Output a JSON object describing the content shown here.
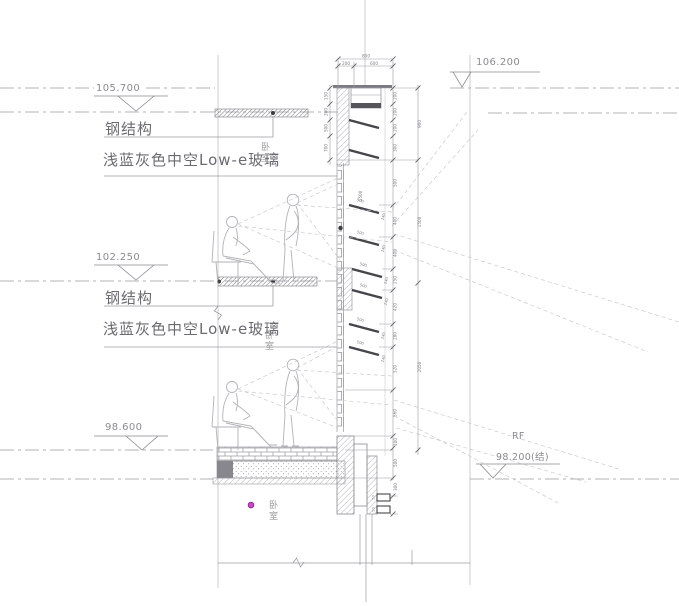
{
  "colors": {
    "line": "#9b9ba1",
    "dark_line": "#55555b",
    "louver": "#45454b",
    "text_gray": "#8b8b91",
    "annotation_gray": "#6b6b71",
    "magenta_dot": "#bf3fbf",
    "background": "#ffffff"
  },
  "levels": {
    "roof_right": {
      "elevation": "106.200"
    },
    "upper": {
      "elevation": "105.700"
    },
    "mid": {
      "elevation": "102.250"
    },
    "floor": {
      "elevation": "98.600"
    },
    "structural": {
      "tag": "RF",
      "elevation": "98.200(结)"
    }
  },
  "annotations": {
    "steel_upper": "钢结构",
    "steel_mid": "钢结构",
    "glass_upper": "浅蓝灰色中空Low-e玻璃",
    "glass_mid": "浅蓝灰色中空Low-e玻璃",
    "room_upper": "卧室",
    "room_mid": "卧室",
    "room_lower": "卧室"
  },
  "dims": {
    "top_overall": "800",
    "top_segments": [
      "200",
      "600"
    ],
    "left_chain": [
      "150",
      "200",
      "500",
      "700"
    ],
    "right_chain": [
      "200",
      "200",
      "200",
      "300",
      "500",
      "400",
      "400",
      "250",
      "420",
      "280",
      "520",
      "560"
    ],
    "outer_chain": [
      "900",
      "1500",
      "2050"
    ],
    "louver_length": "500",
    "louver_depth": "240",
    "interior_height": "1500",
    "bottom_chain": [
      "100",
      "500",
      "300"
    ],
    "bracket": "50"
  }
}
